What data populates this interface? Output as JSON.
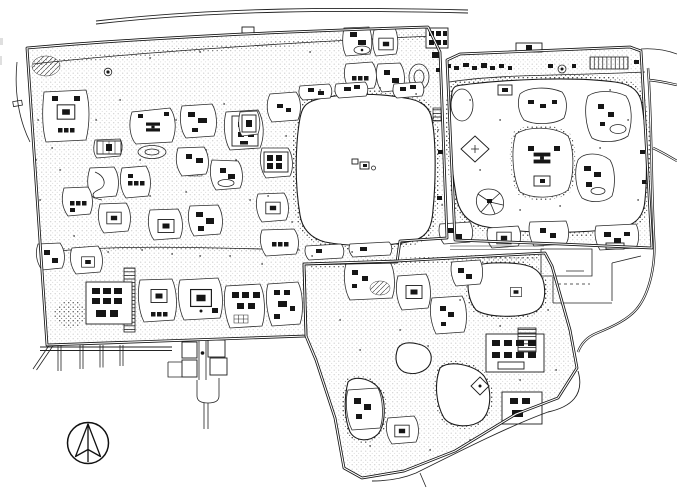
{
  "meta": {
    "description": "Hand-drawn black-and-white architectural site plan of three adjoining walled imperial gardens with large lakes, islands, dense building clusters, winding waterways, entrance gate courtyards and perimeter roads",
    "drawing_style": "ink line drawing, no text labels"
  },
  "colors": {
    "ink": "#1b1b1b",
    "paper": "#ffffff"
  },
  "icons": {
    "compass": "north-arrow-icon"
  }
}
